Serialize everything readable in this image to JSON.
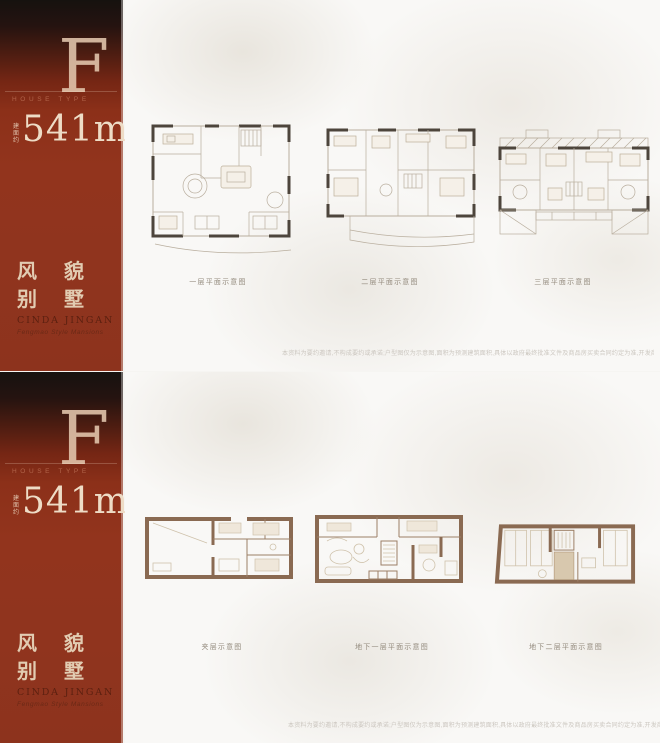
{
  "sidebar": {
    "letter": "F",
    "letter_caption": "HOUSE TYPE",
    "area_prefix": "建\n面\n约",
    "area_value": "541m²",
    "title_line1": "风 貌",
    "title_line2": "别 墅",
    "brand": "CINDA JINGAN",
    "brand_sub": "Fengmao Style Mansions"
  },
  "top_panel": {
    "captions": [
      "一层平面示意图",
      "二层平面示意图",
      "三层平面示意图"
    ],
    "disclaimer": "本资料为要约邀请,不构成要约或承诺;户型图仅为示意图,面积为预测建筑面积,具体以政府最终批准文件及商品房买卖合同约定为准,开发商保留修改权利。"
  },
  "bottom_panel": {
    "captions": [
      "夹层示意图",
      "地下一层平面示意图",
      "地下二层平面示意图"
    ],
    "disclaimer": "本资料为要约邀请,不构成要约或承诺;户型图仅为示意图,面积为预测建筑面积,具体以政府最终批准文件及商品房买卖合同约定为准,开发商保留修改权利。"
  },
  "colors": {
    "sidebar_red": "#90341e",
    "sidebar_top_black": "#16120f",
    "cream_text": "#eedcc6",
    "brand_dark": "#5c2010",
    "plan_wall_dark": "#4d453c",
    "plan_line_light": "#b9ae9e",
    "basement_wall_brown": "#8a6a52",
    "background": "#f9f8f6"
  }
}
